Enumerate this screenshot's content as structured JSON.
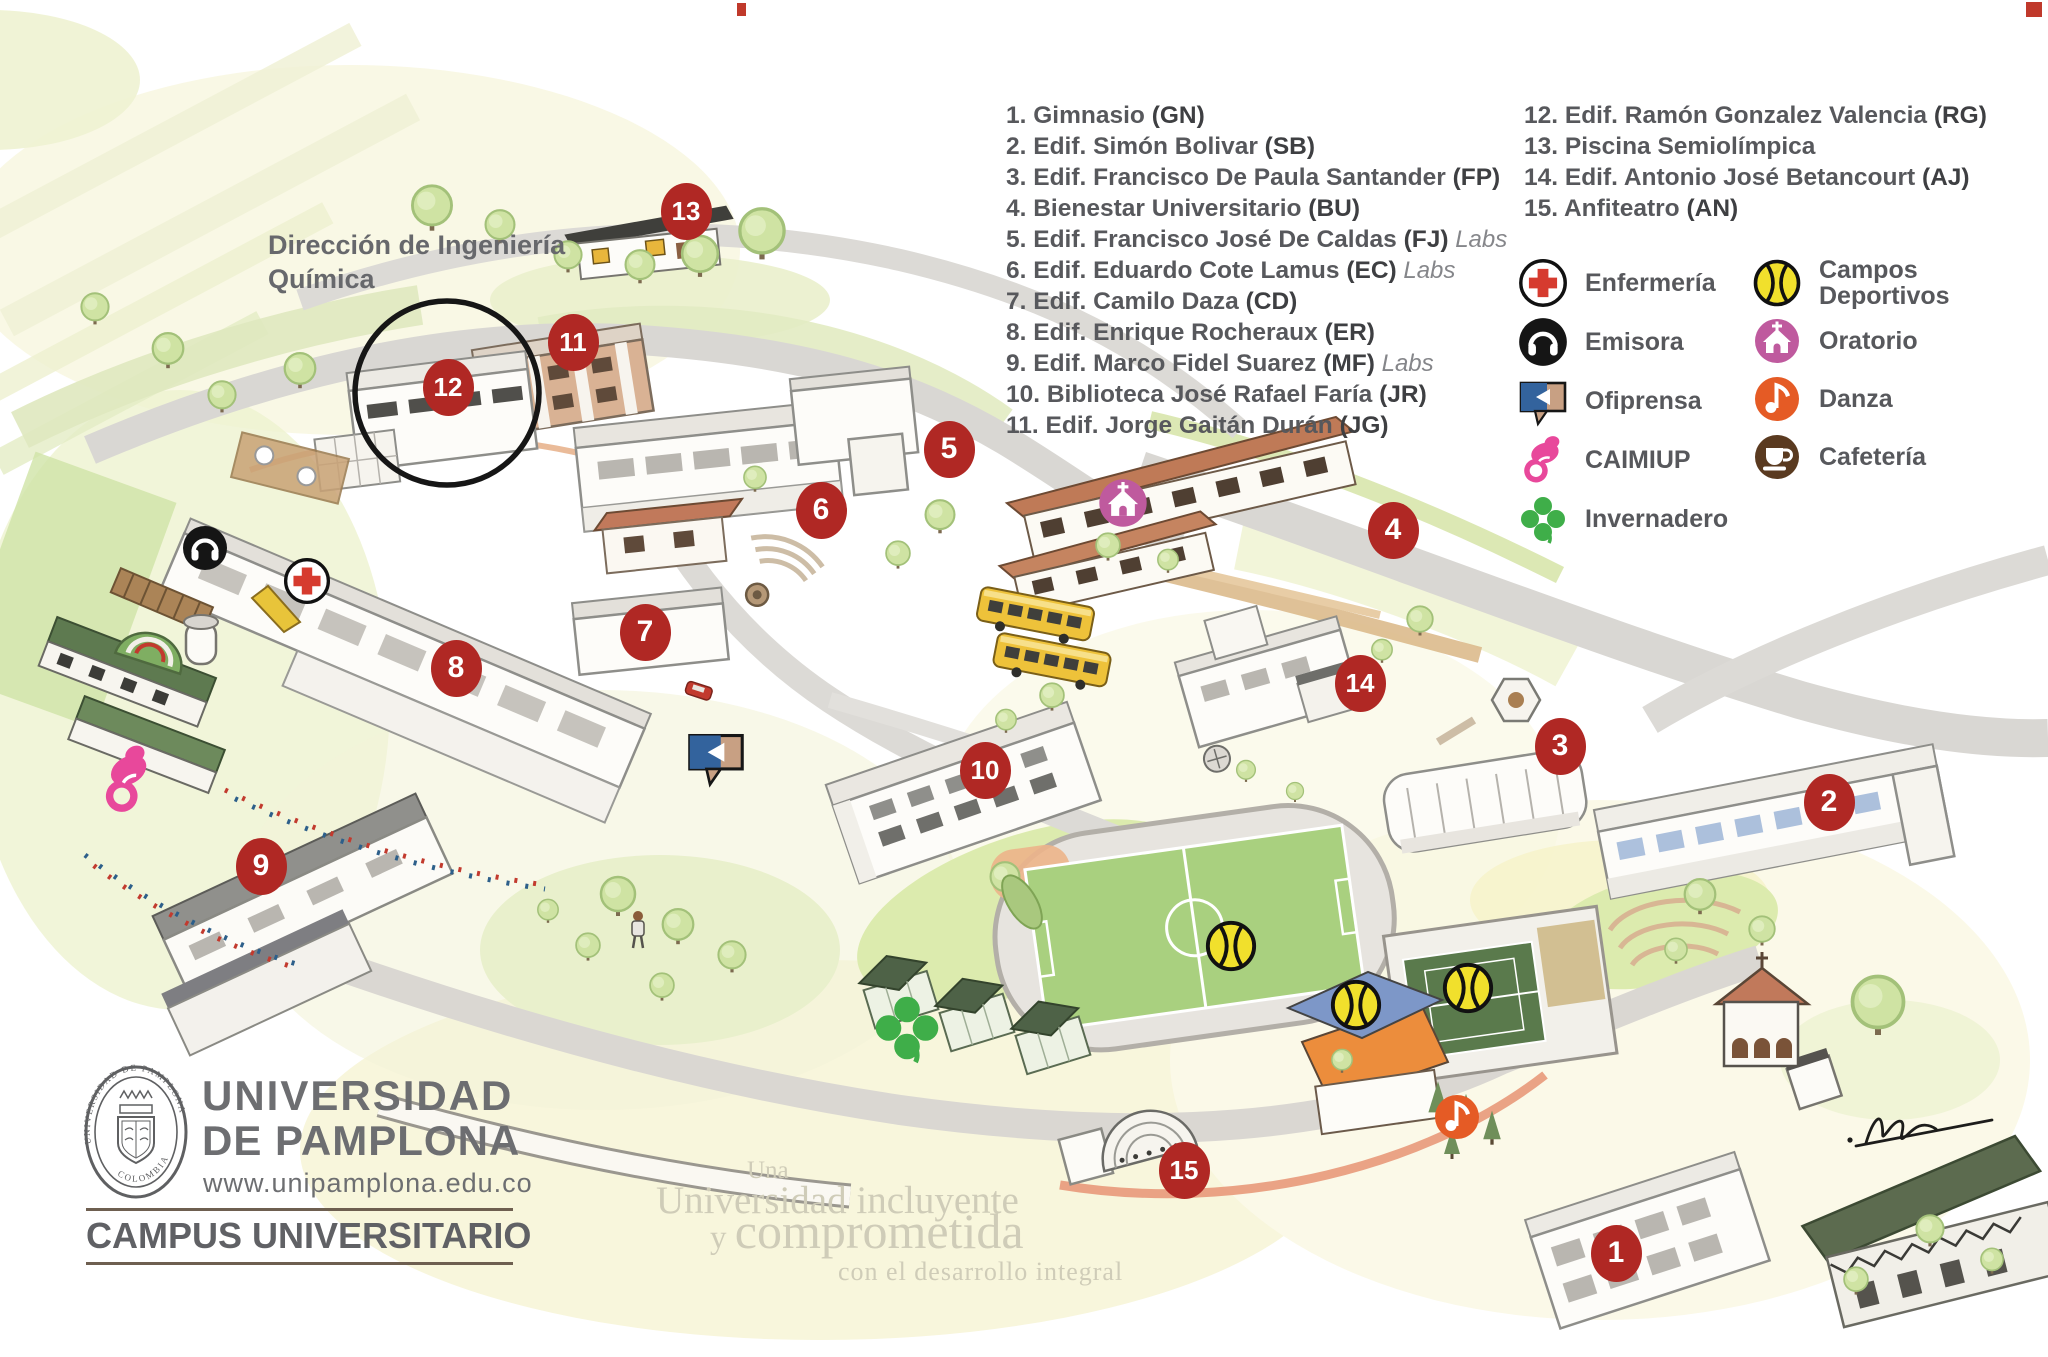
{
  "page": {
    "title": "Campus Universitario - Universidad de Pamplona"
  },
  "note": {
    "line1": "Dirección de Ingeniería",
    "line2": "Química"
  },
  "buildings": {
    "col1": [
      {
        "num": "1",
        "name": "Gimnasio",
        "code": "GN",
        "labs": false
      },
      {
        "num": "2",
        "name": "Edif. Simón Bolivar",
        "code": "SB",
        "labs": false
      },
      {
        "num": "3",
        "name": "Edif. Francisco De Paula Santander",
        "code": "FP",
        "labs": false
      },
      {
        "num": "4",
        "name": "Bienestar Universitario",
        "code": "BU",
        "labs": false
      },
      {
        "num": "5",
        "name": "Edif. Francisco José De Caldas",
        "code": "FJ",
        "labs": true
      },
      {
        "num": "6",
        "name": "Edif. Eduardo Cote Lamus",
        "code": "EC",
        "labs": true
      },
      {
        "num": "7",
        "name": "Edif. Camilo Daza",
        "code": "CD",
        "labs": false
      },
      {
        "num": "8",
        "name": "Edif. Enrique Rocheraux",
        "code": "ER",
        "labs": false
      },
      {
        "num": "9",
        "name": "Edif. Marco Fidel Suarez",
        "code": "MF",
        "labs": true
      },
      {
        "num": "10",
        "name": "Biblioteca José Rafael Faría",
        "code": "JR",
        "labs": false
      },
      {
        "num": "11",
        "name": "Edif. Jorge Gaitán Durán",
        "code": "JG",
        "labs": false
      }
    ],
    "col2": [
      {
        "num": "12",
        "name": "Edif. Ramón Gonzalez Valencia",
        "code": "RG",
        "labs": false
      },
      {
        "num": "13",
        "name": "Piscina Semiolímpica",
        "code": null,
        "labs": false
      },
      {
        "num": "14",
        "name": "Edif. Antonio José Betancourt",
        "code": "AJ",
        "labs": false
      },
      {
        "num": "15",
        "name": "Anfiteatro",
        "code": "AN",
        "labs": false
      }
    ]
  },
  "legend": {
    "col1": [
      {
        "type": "enfermeria",
        "label": "Enfermería"
      },
      {
        "type": "emisora",
        "label": "Emisora"
      },
      {
        "type": "ofiprensa",
        "label": "Ofiprensa"
      },
      {
        "type": "caimiup",
        "label": "CAIMIUP"
      },
      {
        "type": "invernadero",
        "label": "Invernadero"
      }
    ],
    "col2": [
      {
        "type": "campos",
        "label": "Campos Deportivos"
      },
      {
        "type": "oratorio",
        "label": "Oratorio"
      },
      {
        "type": "danza",
        "label": "Danza"
      },
      {
        "type": "cafeteria",
        "label": "Cafetería"
      }
    ]
  },
  "branding": {
    "line1": "UNIVERSIDAD",
    "line2": "DE PAMPLONA",
    "url": "www.unipamplona.edu.co",
    "campus": "CAMPUS UNIVERSITARIO",
    "seal_top": "UNIVERSIDAD DE PAMPLONA",
    "seal_bottom": "COLOMBIA"
  },
  "watermark": {
    "l1": "Una",
    "l2": "Universidad incluyente",
    "l3a": "y ",
    "l3b": "comprometida",
    "l4": "con el desarrollo integral"
  },
  "map": {
    "markers": [
      {
        "n": "1",
        "x": 1616,
        "y": 1253
      },
      {
        "n": "2",
        "x": 1829,
        "y": 802
      },
      {
        "n": "3",
        "x": 1560,
        "y": 746
      },
      {
        "n": "4",
        "x": 1393,
        "y": 530
      },
      {
        "n": "5",
        "x": 949,
        "y": 449
      },
      {
        "n": "6",
        "x": 821,
        "y": 510
      },
      {
        "n": "7",
        "x": 645,
        "y": 632
      },
      {
        "n": "8",
        "x": 456,
        "y": 668
      },
      {
        "n": "9",
        "x": 261,
        "y": 866
      },
      {
        "n": "10",
        "x": 985,
        "y": 770
      },
      {
        "n": "11",
        "x": 573,
        "y": 342
      },
      {
        "n": "12",
        "x": 448,
        "y": 387
      },
      {
        "n": "13",
        "x": 686,
        "y": 211
      },
      {
        "n": "14",
        "x": 1360,
        "y": 683
      },
      {
        "n": "15",
        "x": 1184,
        "y": 1170
      }
    ],
    "icons": [
      {
        "type": "emisora",
        "x": 205,
        "y": 548,
        "size": 48
      },
      {
        "type": "enfermeria",
        "x": 307,
        "y": 581,
        "size": 50
      },
      {
        "type": "ofiprensa",
        "x": 716,
        "y": 757,
        "size": 62
      },
      {
        "type": "caimiup",
        "x": 128,
        "y": 780,
        "size": 70,
        "rot": -12
      },
      {
        "type": "oratorio",
        "x": 1123,
        "y": 503,
        "size": 56
      },
      {
        "type": "invernadero",
        "x": 907,
        "y": 1028,
        "size": 74
      },
      {
        "type": "campos",
        "x": 1231,
        "y": 946,
        "size": 56
      },
      {
        "type": "campos",
        "x": 1356,
        "y": 1005,
        "size": 56
      },
      {
        "type": "campos",
        "x": 1468,
        "y": 988,
        "size": 56
      },
      {
        "type": "danza",
        "x": 1457,
        "y": 1117,
        "size": 52
      }
    ]
  },
  "colors": {
    "marker_red": "#b02824",
    "text_dark": "#57585c",
    "enfermeria_red": "#d63b2f",
    "emisora_black": "#151515",
    "ofiprensa_blue": "#33639d",
    "ofiprensa_tan": "#c8a083",
    "caimiup_pink": "#e8489b",
    "invernadero_green": "#3fae49",
    "campos_yellow": "#f1e02c",
    "oratorio_pink": "#bf5a9e",
    "danza_orange": "#e55b25",
    "cafeteria_brown": "#5a3a20"
  }
}
